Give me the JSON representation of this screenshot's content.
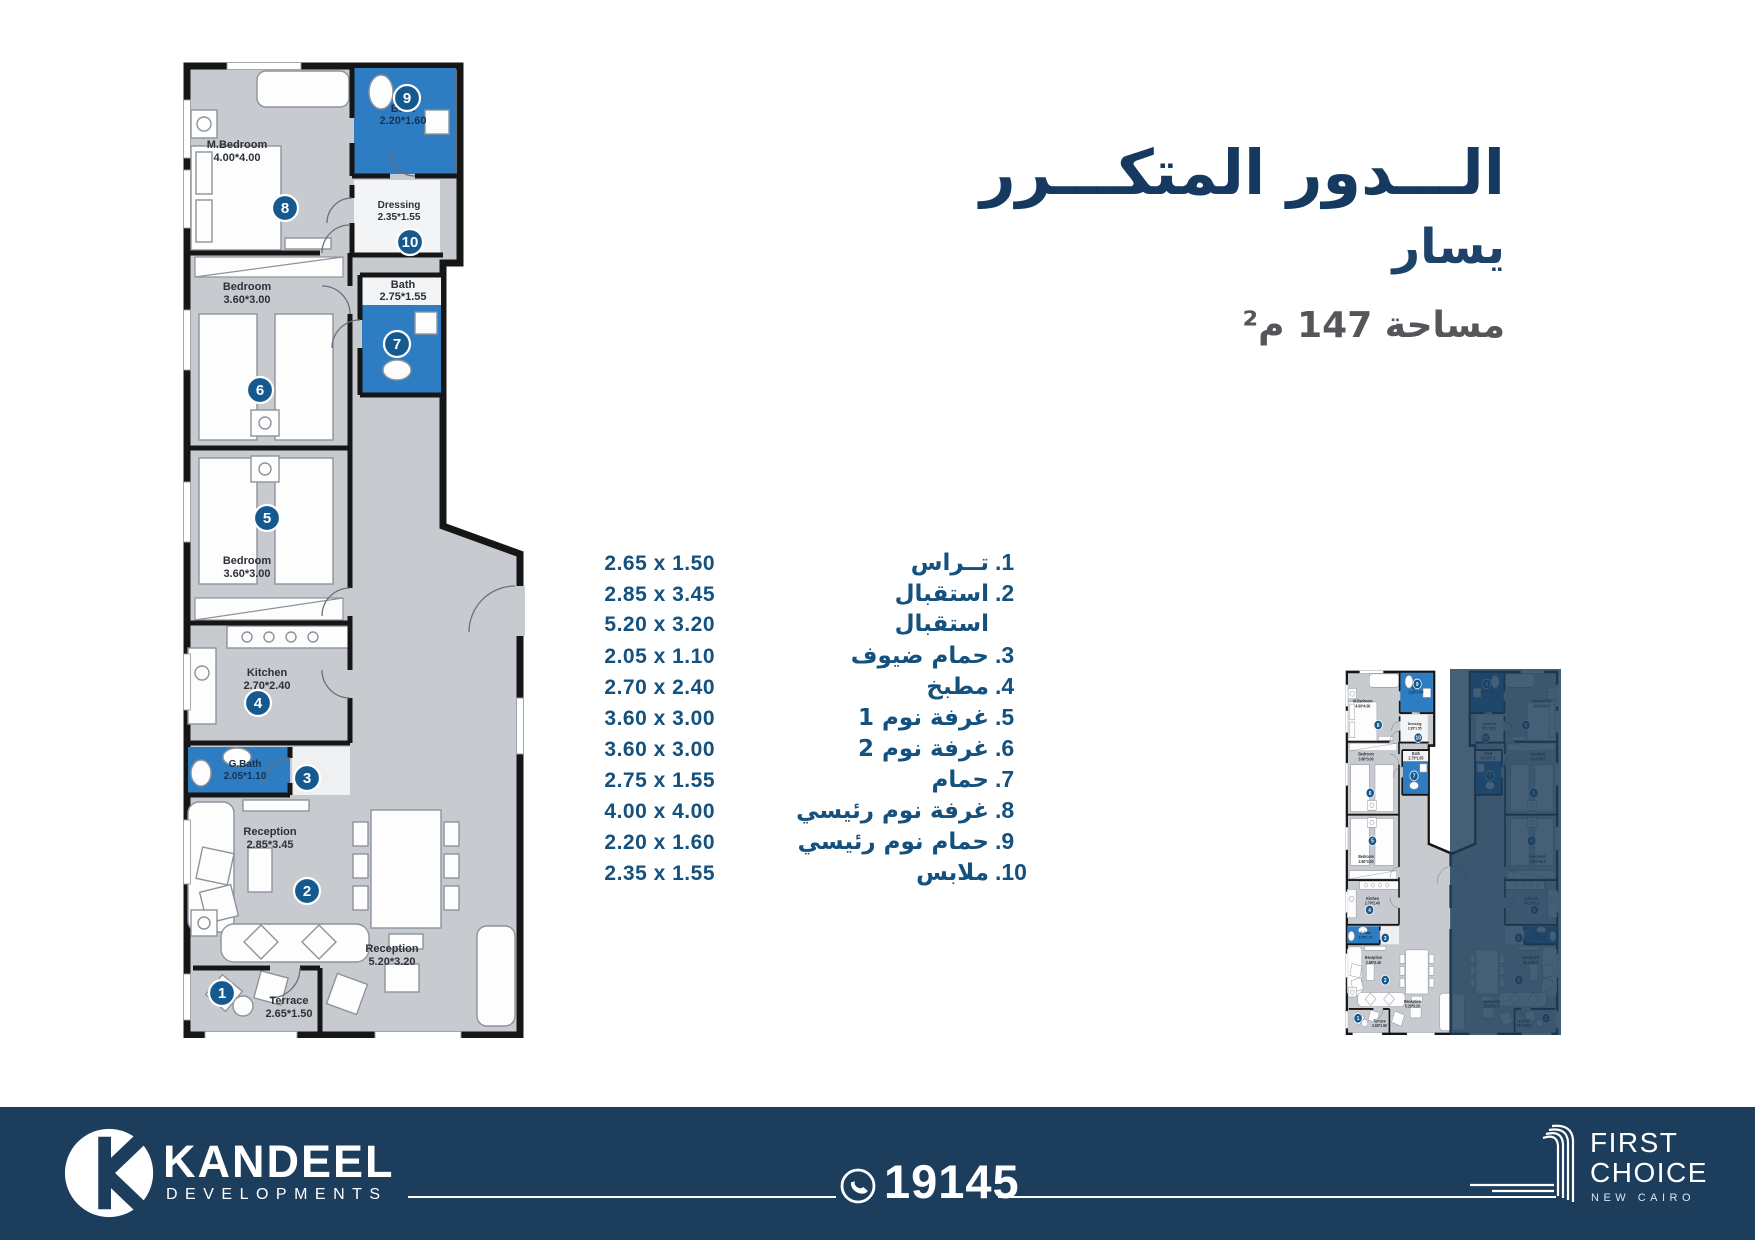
{
  "title": {
    "line1": "الـــدور المتكـــرر",
    "line2": "يسار",
    "area": "مساحة 147 م²"
  },
  "room_list": [
    {
      "num": "1.",
      "name": "تــراس",
      "dims": "2.65 x 1.50"
    },
    {
      "num": "2.",
      "name": "استقبال",
      "dims": "2.85 x 3.45"
    },
    {
      "num": "",
      "name": "استقبال",
      "dims": "5.20 x 3.20"
    },
    {
      "num": "3.",
      "name": "حمام ضيوف",
      "dims": "2.05 x 1.10"
    },
    {
      "num": "4.",
      "name": "مطبخ",
      "dims": "2.70 x 2.40"
    },
    {
      "num": "5.",
      "name": "غرفة نوم 1",
      "dims": "3.60 x 3.00"
    },
    {
      "num": "6.",
      "name": "غرفة نوم 2",
      "dims": "3.60 x 3.00"
    },
    {
      "num": "7.",
      "name": "حمام",
      "dims": "2.75 x 1.55"
    },
    {
      "num": "8.",
      "name": "غرفة نوم رئيسي",
      "dims": "4.00 x 4.00"
    },
    {
      "num": "9.",
      "name": "حمام نوم رئيسي",
      "dims": "2.20 x 1.60"
    },
    {
      "num": "10.",
      "name": "ملابس",
      "dims": "2.35 x 1.55"
    }
  ],
  "plan": {
    "rooms": {
      "m_bedroom": {
        "name": "M.Bedroom",
        "dims": "4.00*4.00",
        "marker": "8"
      },
      "bath9": {
        "name": "Bath",
        "dims": "2.20*1.60",
        "marker": "9"
      },
      "dressing": {
        "name": "Dressing",
        "dims": "2.35*1.55",
        "marker": "10"
      },
      "bath7": {
        "name": "Bath",
        "dims": "2.75*1.55",
        "marker": "7"
      },
      "bedroom6": {
        "name": "Bedroom",
        "dims": "3.60*3.00",
        "marker": "6"
      },
      "bedroom5": {
        "name": "Bedroom",
        "dims": "3.60*3.00",
        "marker": "5"
      },
      "kitchen": {
        "name": "Kitchen",
        "dims": "2.70*2.40",
        "marker": "4"
      },
      "gbath": {
        "name": "G.Bath",
        "dims": "2.05*1.10",
        "marker": "3"
      },
      "reception2": {
        "name": "Reception",
        "dims": "2.85*3.45",
        "marker": "2"
      },
      "reception_b": {
        "name": "Reception",
        "dims": "5.20*3.20"
      },
      "terrace": {
        "name": "Terrace",
        "dims": "2.65*1.50",
        "marker": "1"
      }
    }
  },
  "footer": {
    "brand": "KANDEEL",
    "brand_sub": "DEVELOPMENTS",
    "phone": "19145",
    "fc_line1": "FIRST",
    "fc_line2": "CHOICE",
    "fc_sub": "NEW CAIRO"
  },
  "colors": {
    "title_navy": "#16395f",
    "list_blue": "#14517f",
    "area_gray": "#55565a",
    "bath_blue": "#2e7dc2",
    "plan_gray": "#c7cbd0",
    "wall_black": "#161616",
    "marker_blue": "#15598e",
    "footer_navy": "#1d3d5c",
    "mini_overlay_navy": "#1c3c59"
  }
}
